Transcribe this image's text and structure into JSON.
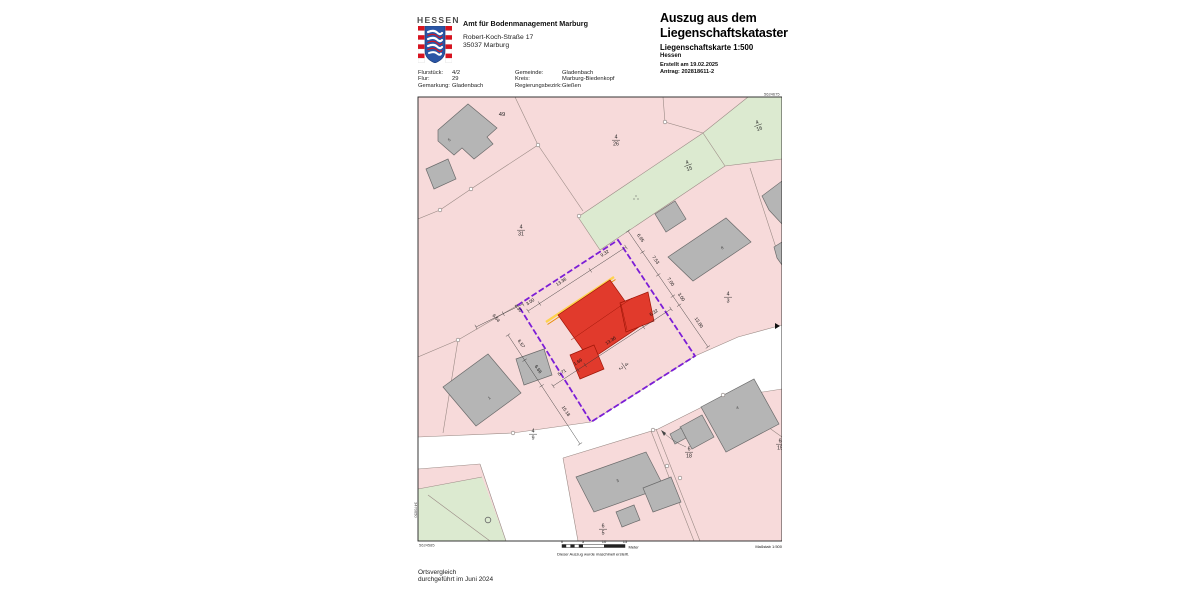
{
  "header": {
    "logo_text": "HESSEN",
    "office_name": "Amt für Bodenmanagement Marburg",
    "office_street": "Robert-Koch-Straße 17",
    "office_city": "35037 Marburg",
    "title_line1": "Auszug aus dem",
    "title_line2": "Liegenschaftskataster",
    "subtitle": "Liegenschaftskarte 1:500",
    "state": "Hessen",
    "created": "Erstellt am 19.02.2025",
    "request": "Antrag: 202818611-2"
  },
  "info": {
    "flurstueck_label": "Flurstück:",
    "flurstueck": "4/2",
    "flur_label": "Flur:",
    "flur": "29",
    "gemarkung_label": "Gemarkung:",
    "gemarkung": "Gladenbach",
    "gemeinde_label": "Gemeinde:",
    "gemeinde": "Gladenbach",
    "kreis_label": "Kreis:",
    "kreis": "Marburg-Biedenkopf",
    "regbez_label": "Regierungsbezirk:",
    "regbez": "Gießen"
  },
  "map": {
    "corner_top_right": "5624675",
    "corner_bottom_left": "5624585",
    "edge_right": "3470724",
    "edge_left": "3470650",
    "parcels": {
      "p49": "49",
      "p4_26": {
        "num": "4",
        "den": "26"
      },
      "p4_16": {
        "num": "4",
        "den": "16"
      },
      "p4_15": {
        "num": "4",
        "den": "15"
      },
      "p4_31": {
        "num": "4",
        "den": "31"
      },
      "p4_3": {
        "num": "4",
        "den": "3"
      },
      "p4_2": {
        "num": "4",
        "den": "2"
      },
      "p4_9": {
        "num": "4",
        "den": "9"
      },
      "p6_18": {
        "num": "6",
        "den": "18"
      },
      "p6_5": {
        "num": "6",
        "den": "5"
      },
      "p6_15": {
        "num": "6",
        "den": "15"
      }
    },
    "building_labels": {
      "b49": "5",
      "b4_9": "1",
      "b4_3": "8",
      "b6_18": "4",
      "b6_5": "3"
    },
    "meas": {
      "nw": [
        "3.00",
        "13.36",
        "9.32"
      ],
      "ne": [
        "6.95",
        "7.53",
        "7.00",
        "3.00",
        "13.80"
      ],
      "se": [
        "5.71",
        "1.69",
        "13.36",
        "6.32"
      ],
      "sw": [
        "4.30",
        "6.54",
        "6.57",
        "6.66",
        "15.18"
      ]
    },
    "scale": {
      "t0": "0",
      "t1": "5",
      "t2": "10",
      "t3": "15",
      "unit": "Meter",
      "masstab": "Maßstab 1:500"
    },
    "note": "Dieser Auszug wurde maschinell erstellt."
  },
  "footer": {
    "line1": "Ortsvergleich",
    "line2": "durchgeführt im Juni 2024"
  },
  "colors": {
    "parcel_pink": "#f7dada",
    "parcel_green": "#dcead0",
    "building_gray": "#b5b5b5",
    "highlight_red": "#e13a2c",
    "boundary_purple": "#7c1ed6",
    "stripe_yellow": "#ffd24d"
  }
}
